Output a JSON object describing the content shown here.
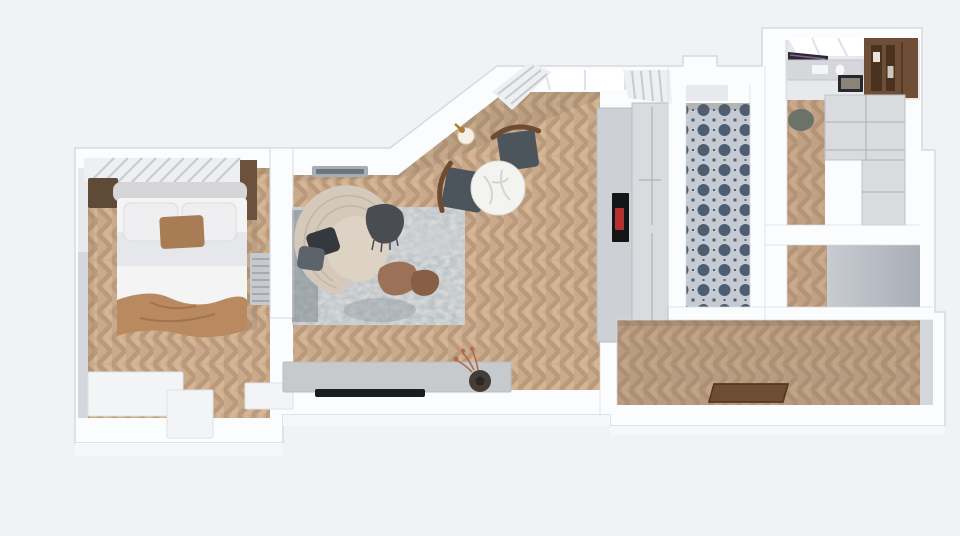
{
  "meta": {
    "description": "Top-down 3D architectural render of an elongated studio apartment floor plan",
    "width": 960,
    "height": 536
  },
  "colors": {
    "background": "#f1f2f4",
    "wall_top": "#fbfcfd",
    "wall_edge": "#d6dade",
    "wall_face": "#d4d7db",
    "wall_face_light": "#e7e9ec",
    "wall_front": "#f6f7f9",
    "floor_base": "#c9aa8c",
    "floor_chevron_dark": "#bb9a7c",
    "floor_chevron_light": "#d4b695",
    "floor_tint_hall": "#7d6a55",
    "floor_tint_right": "#8a7560",
    "floor_shadow": "#6b5a44",
    "rug_base": "#b1b7ba",
    "rug_light": "#ced2d2",
    "rug_dark": "#8e979c",
    "rug_edge": "#7f888e",
    "sofa_body": "#d4c9ba",
    "sofa_seat": "#ddd3c5",
    "sofa_rib": "#beb19f",
    "throw_dark": "#494c51",
    "pillow_dark": "#35383c",
    "pillow_gray": "#5c636a",
    "pouf_brown": "#9b7257",
    "pouf_brown_dark": "#875f45",
    "bed_duvet": "#f4f4f5",
    "bed_sheet": "#e6e7ea",
    "bed_pillow": "#efeff1",
    "pillow_accent": "#a87c55",
    "bed_throw": "#b98a5f",
    "headboard": "#d6d6d8",
    "nightstand": "#5f4a38",
    "wardrobe_strip": "#6a523d",
    "radiator": "#c6cacf",
    "radiator_line": "#9aa0a7",
    "blind": "#edeff1",
    "blind_stripe": "#c5cbd0",
    "dresser": "#f3f4f6",
    "marble": "#f3f3f0",
    "marble_vein": "#c9cdc9",
    "chair_seat": "#4c545c",
    "chair_wood": "#6e4b31",
    "lamp_gold": "#ad7b33",
    "lamp_shade": "#f6f1e6",
    "console": "#c7cacd",
    "tv_black": "#1a1c1f",
    "vase_dark": "#443d37",
    "flowers_rust": "#b26b49",
    "cabinet_light": "#cdd0d4",
    "cabinet_lighter": "#d9dbde",
    "cabinet_line": "#b4b8bd",
    "oven_black": "#141517",
    "oven_red": "#b23230",
    "tile_bg": "#c6cbd3",
    "tile_motif": "#4d5e72",
    "walnut": "#6e4e36",
    "walnut_dark": "#49331f",
    "counter": "#d5d7da",
    "wall_tv": "#2a2b30",
    "wall_tv_sheen": "#8a5b9a",
    "frame_dark": "#26282c",
    "frame_img": "#8a8378",
    "chair_sage": "#6b7268",
    "doormat": "#6d4e35",
    "doormat_dark": "#54391f",
    "window_glow": "#ffffff",
    "window_frame": "#dfe3e8",
    "vent": "#a7adb4",
    "vent_slot": "#6d737a",
    "closet_shade_from": "#c8ccd2",
    "closet_shade_to": "#a9adb5"
  },
  "rooms": [
    {
      "name": "bedroom"
    },
    {
      "name": "living-room"
    },
    {
      "name": "dining-area"
    },
    {
      "name": "kitchenette"
    },
    {
      "name": "bathroom"
    },
    {
      "name": "utility-room"
    },
    {
      "name": "closet"
    },
    {
      "name": "hallway"
    }
  ],
  "furniture": [
    "double-bed",
    "nightstand",
    "headboard",
    "window-blind",
    "radiator",
    "dresser",
    "crescent-sofa",
    "area-rug",
    "coffee-poufs",
    "tv-console",
    "television",
    "vase",
    "dining-table",
    "dining-chairs",
    "wall-lamp",
    "ac-vent",
    "tall-cabinet",
    "built-in-oven",
    "tile-floor",
    "kitchen-counter",
    "wall-screen",
    "picture-frame",
    "walnut-shelf",
    "base-cabinet",
    "stool",
    "doormat"
  ]
}
